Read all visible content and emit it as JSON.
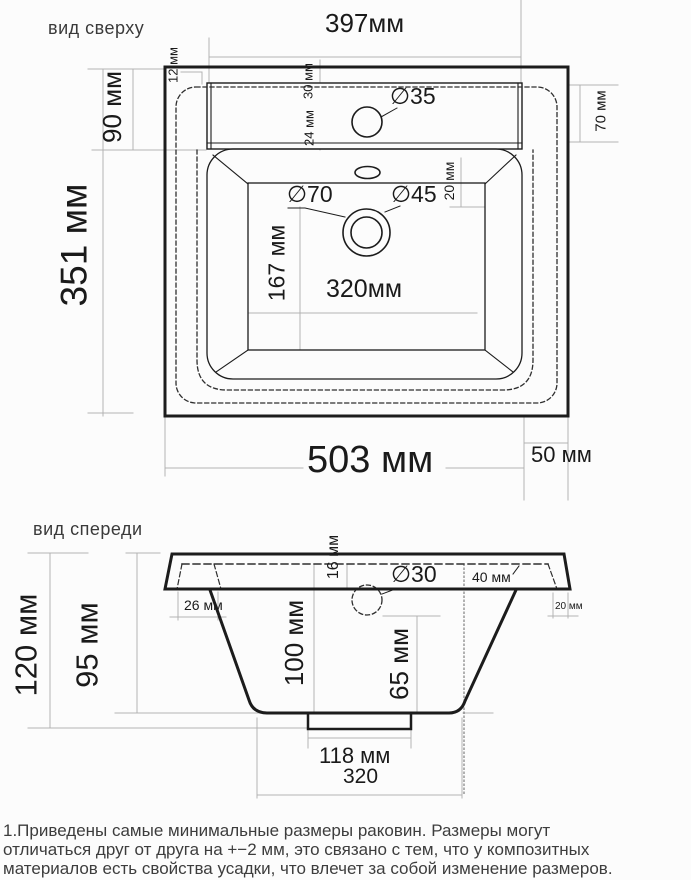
{
  "document": {
    "type": "sink-dimension-drawing",
    "units": "мм"
  },
  "colors": {
    "outline": "#1c1c1c",
    "dashed_hidden": "#2e2e2e",
    "dimension_line": "#b3b3b3",
    "text": "#1a1a1a",
    "background": "#fcfcfc"
  },
  "top_view": {
    "title": "вид сверху",
    "labels": {
      "deck_width": "397мм",
      "edge_offset": "12 мм",
      "deck_depth": "90 мм",
      "total_depth": "351 мм",
      "hole_front_offset": "30 мм",
      "hole_back_offset": "24 мм",
      "faucet_hole_diameter": "∅35",
      "right_rim": "70 мм",
      "drain_outer_diameter": "∅70",
      "drain_inner_diameter": "∅45",
      "basin_right_gap": "20 мм",
      "basin_depth": "167 мм",
      "basin_width": "320мм",
      "total_width": "503 мм",
      "right_offset": "50 мм"
    }
  },
  "front_view": {
    "title": "вид спереди",
    "labels": {
      "total_height": "120 мм",
      "body_height": "95 мм",
      "rim_thickness": "16 мм",
      "left_inset": "26 мм",
      "drain_hole_diameter": "∅30",
      "drain_offset": "40 мм",
      "right_edge_overhang": "20 мм",
      "bowl_depth": "100 мм",
      "drain_depth": "65 мм",
      "foot_width": "118 мм",
      "bottom_width": "320"
    }
  },
  "footer": {
    "note_lines": [
      "1.Приведены самые минимальные размеры раковин. Размеры могут",
      "отличаться друг от друга на +−2 мм, это связано с тем, что у композитных",
      "материалов есть свойства усадки, что влечет за собой изменение размеров."
    ]
  }
}
